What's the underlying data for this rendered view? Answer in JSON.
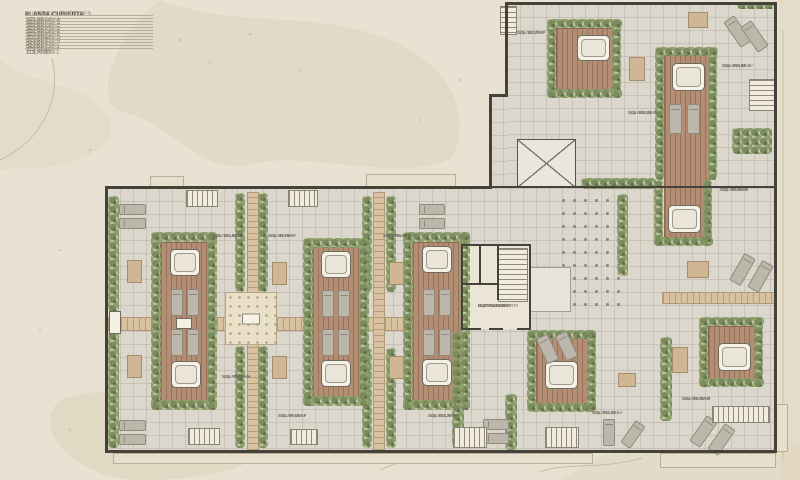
{
  "sheet": {
    "width": 800,
    "height": 480
  },
  "colors": {
    "background": "#e9e2d3",
    "paving": "#dcd7cd",
    "deck_wood": "#b48d75",
    "boardwalk_wood": "#d8c2a1",
    "hedge_green": "#7a8b5c",
    "wall": "#45423a",
    "label_text": "#6a6456",
    "legend_header": "#56524a",
    "terrain_blob": "#ddd2bb"
  },
  "legend": {
    "title_left": "SUPERFICIES ÚTILES",
    "title_right": "PLANTA CUBIERTA",
    "rows": [
      {
        "name": "SOLARIUM-A",
        "value": "103,90 m²"
      },
      {
        "name": "SOLARIUM-B",
        "value": "93,30 m²"
      },
      {
        "name": "SOLARIUM-C",
        "value": "102,85 m²"
      },
      {
        "name": "SOLARIUM-D",
        "value": "93,90 m²"
      },
      {
        "name": "SOLARIUM-E",
        "value": "106,40 m²"
      },
      {
        "name": "SOLARIUM-F",
        "value": "92,17 m²"
      },
      {
        "name": "SOLARIUM-G",
        "value": "112,50 m²"
      },
      {
        "name": "SOLARIUM-H",
        "value": "69,85 m²"
      },
      {
        "name": "SOLARIUM-I",
        "value": "84,65 m²"
      },
      {
        "name": "SOLARIUM-J",
        "value": "84,65 m²"
      },
      {
        "name": "SOLARIUM-K",
        "value": "113,70 m²"
      },
      {
        "name": "SOLARIUM-L",
        "value": "113,70 m²"
      }
    ]
  },
  "plan": {
    "paving": [
      [
        507,
        4,
        269,
        184
      ],
      [
        490,
        96,
        18,
        92
      ],
      [
        107,
        188,
        668,
        263
      ]
    ],
    "ledges": [
      [
        150,
        176,
        34,
        11
      ],
      [
        366,
        174,
        90,
        13
      ],
      [
        113,
        453,
        480,
        11
      ],
      [
        660,
        453,
        116,
        15
      ],
      [
        776,
        404,
        12,
        48
      ]
    ],
    "boardwalks_h": [
      [
        108,
        317,
        355,
        14
      ],
      [
        662,
        292,
        113,
        12
      ]
    ],
    "boardwalks_v": [
      [
        247,
        192,
        12,
        259
      ],
      [
        373,
        192,
        12,
        259
      ]
    ],
    "plaza": [
      [
        225,
        292,
        52,
        53
      ]
    ],
    "planters": [
      [
        109,
        311,
        12,
        23
      ],
      [
        176,
        318,
        16,
        11
      ]
    ],
    "dots": [
      [
        558,
        194,
        62,
        118
      ]
    ],
    "skylights_x": [
      [
        517,
        139,
        59,
        49
      ]
    ],
    "skylights_p": [
      [
        527,
        267,
        44,
        45
      ]
    ],
    "corefloor": [
      [
        462,
        246,
        68,
        83
      ]
    ],
    "decks": [
      [
        160,
        242,
        49,
        160
      ],
      [
        312,
        247,
        49,
        151
      ],
      [
        412,
        242,
        50,
        160
      ],
      [
        536,
        338,
        52,
        66
      ],
      [
        664,
        55,
        46,
        183
      ],
      [
        708,
        326,
        48,
        54
      ],
      [
        556,
        28,
        58,
        62
      ]
    ],
    "hedges": [
      [
        108,
        196,
        11,
        116
      ],
      [
        108,
        332,
        11,
        116
      ],
      [
        235,
        193,
        10,
        99
      ],
      [
        258,
        193,
        10,
        99
      ],
      [
        235,
        346,
        10,
        102
      ],
      [
        258,
        346,
        10,
        102
      ],
      [
        362,
        196,
        10,
        96
      ],
      [
        386,
        196,
        10,
        96
      ],
      [
        362,
        348,
        10,
        100
      ],
      [
        386,
        348,
        10,
        100
      ],
      [
        151,
        232,
        66,
        10
      ],
      [
        151,
        400,
        66,
        10
      ],
      [
        151,
        232,
        10,
        178
      ],
      [
        207,
        232,
        10,
        178
      ],
      [
        303,
        238,
        66,
        10
      ],
      [
        303,
        396,
        66,
        10
      ],
      [
        303,
        238,
        10,
        168
      ],
      [
        359,
        238,
        10,
        168
      ],
      [
        403,
        232,
        67,
        10
      ],
      [
        403,
        400,
        67,
        10
      ],
      [
        403,
        232,
        10,
        178
      ],
      [
        460,
        232,
        10,
        178
      ],
      [
        527,
        330,
        69,
        9
      ],
      [
        527,
        403,
        69,
        9
      ],
      [
        527,
        330,
        9,
        82
      ],
      [
        587,
        330,
        9,
        82
      ],
      [
        654,
        180,
        9,
        66
      ],
      [
        654,
        237,
        59,
        9
      ],
      [
        703,
        180,
        9,
        66
      ],
      [
        547,
        19,
        75,
        9
      ],
      [
        547,
        89,
        75,
        9
      ],
      [
        547,
        19,
        9,
        79
      ],
      [
        612,
        19,
        9,
        79
      ],
      [
        655,
        47,
        63,
        9
      ],
      [
        655,
        47,
        9,
        133
      ],
      [
        708,
        47,
        9,
        133
      ],
      [
        699,
        317,
        65,
        9
      ],
      [
        699,
        378,
        65,
        9
      ],
      [
        699,
        317,
        9,
        70
      ],
      [
        754,
        317,
        9,
        70
      ],
      [
        581,
        178,
        75,
        11
      ],
      [
        737,
        2,
        38,
        7
      ],
      [
        617,
        194,
        11,
        82
      ],
      [
        505,
        394,
        12,
        56
      ],
      [
        452,
        332,
        12,
        116
      ],
      [
        660,
        337,
        12,
        84
      ],
      [
        732,
        128,
        40,
        26
      ]
    ],
    "jacuzzis": [
      [
        170,
        249,
        30,
        27
      ],
      [
        171,
        361,
        30,
        27
      ],
      [
        321,
        251,
        30,
        27
      ],
      [
        321,
        360,
        30,
        27
      ],
      [
        422,
        246,
        30,
        27
      ],
      [
        422,
        359,
        30,
        27
      ],
      [
        545,
        361,
        33,
        28
      ],
      [
        672,
        63,
        33,
        28
      ],
      [
        668,
        205,
        33,
        28
      ],
      [
        718,
        343,
        33,
        28
      ],
      [
        577,
        35,
        33,
        26
      ]
    ],
    "beds": [
      [
        171,
        289,
        12,
        27
      ],
      [
        187,
        289,
        12,
        27
      ],
      [
        171,
        329,
        12,
        27
      ],
      [
        187,
        329,
        12,
        27
      ],
      [
        322,
        290,
        12,
        27
      ],
      [
        338,
        290,
        12,
        27
      ],
      [
        322,
        329,
        12,
        27
      ],
      [
        338,
        329,
        12,
        27
      ],
      [
        423,
        289,
        12,
        27
      ],
      [
        439,
        289,
        12,
        27
      ],
      [
        423,
        329,
        12,
        27
      ],
      [
        439,
        329,
        12,
        27
      ],
      [
        669,
        104,
        13,
        30
      ],
      [
        687,
        104,
        13,
        30
      ],
      [
        119,
        204,
        27,
        11
      ],
      [
        119,
        218,
        27,
        11
      ],
      [
        119,
        420,
        27,
        11
      ],
      [
        119,
        434,
        27,
        11
      ],
      [
        483,
        419,
        26,
        11
      ],
      [
        483,
        433,
        26,
        11
      ],
      [
        419,
        204,
        26,
        11
      ],
      [
        419,
        218,
        26,
        11
      ],
      [
        603,
        419,
        12,
        27
      ],
      [
        627,
        421,
        12,
        27,
        35
      ],
      [
        731,
        16,
        13,
        31,
        -35
      ],
      [
        748,
        21,
        13,
        31,
        -35
      ],
      [
        736,
        254,
        13,
        31,
        30
      ],
      [
        754,
        261,
        13,
        31,
        30
      ],
      [
        541,
        335,
        13,
        28,
        -25
      ],
      [
        560,
        332,
        13,
        28,
        -25
      ],
      [
        697,
        416,
        13,
        31,
        35
      ],
      [
        715,
        424,
        13,
        31,
        35
      ]
    ],
    "tables": [
      [
        127,
        260,
        15,
        23
      ],
      [
        127,
        355,
        15,
        23
      ],
      [
        272,
        262,
        15,
        23
      ],
      [
        272,
        356,
        15,
        23
      ],
      [
        389,
        262,
        15,
        23
      ],
      [
        389,
        356,
        15,
        23
      ],
      [
        672,
        347,
        16,
        26
      ],
      [
        629,
        57,
        16,
        24
      ],
      [
        687,
        261,
        22,
        17
      ],
      [
        688,
        12,
        20,
        16
      ],
      [
        618,
        373,
        18,
        14
      ]
    ],
    "stairs_h": [
      [
        186,
        190,
        32,
        17
      ],
      [
        288,
        190,
        30,
        17
      ],
      [
        188,
        428,
        32,
        17
      ],
      [
        290,
        429,
        28,
        16
      ],
      [
        453,
        427,
        34,
        21
      ],
      [
        545,
        427,
        34,
        21
      ],
      [
        712,
        406,
        58,
        17
      ]
    ],
    "stairs_v": [
      [
        749,
        79,
        26,
        32
      ],
      [
        500,
        6,
        17,
        29
      ],
      [
        498,
        248,
        30,
        54
      ]
    ],
    "walls": [
      [
        506,
        2,
        271,
        3
      ],
      [
        774,
        2,
        3,
        451
      ],
      [
        505,
        2,
        3,
        95
      ],
      [
        490,
        94,
        18,
        3
      ],
      [
        489,
        94,
        3,
        95
      ],
      [
        105,
        186,
        387,
        3
      ],
      [
        489,
        186,
        288,
        2
      ],
      [
        105,
        186,
        3,
        267
      ],
      [
        105,
        450,
        672,
        3
      ],
      [
        461,
        244,
        70,
        2
      ],
      [
        461,
        244,
        2,
        86
      ],
      [
        529,
        244,
        2,
        86
      ],
      [
        461,
        328,
        20,
        2
      ],
      [
        489,
        328,
        14,
        2
      ],
      [
        517,
        328,
        14,
        2
      ],
      [
        461,
        283,
        38,
        2
      ],
      [
        479,
        244,
        2,
        40
      ],
      [
        497,
        244,
        2,
        56
      ]
    ],
    "labels": [
      {
        "x": 517,
        "y": 30,
        "lines": [
          "SOLARIUM-F",
          "Sup: 92,17 m²"
        ]
      },
      {
        "x": 722,
        "y": 63,
        "lines": [
          "SOLARIUM-A",
          "Sup: 103,90 m²"
        ]
      },
      {
        "x": 628,
        "y": 110,
        "lines": [
          "SOLARIUM-C",
          "Sup: 102,85 m²"
        ]
      },
      {
        "x": 720,
        "y": 187,
        "lines": [
          "SOLARIUM-D",
          "Sup: 93,90 m²"
        ]
      },
      {
        "x": 213,
        "y": 233,
        "lines": [
          "SOLARIUM-G",
          "Sup: 112,50 m²"
        ]
      },
      {
        "x": 268,
        "y": 233,
        "lines": [
          "SOLARIUM-I",
          "Sup: 84,65 m²"
        ]
      },
      {
        "x": 383,
        "y": 233,
        "lines": [
          "SOLARIUM-E",
          "Sup: 106,40 m²"
        ]
      },
      {
        "x": 222,
        "y": 374,
        "lines": [
          "SOLARIUM-H",
          "Sup: 69,85 m²"
        ]
      },
      {
        "x": 278,
        "y": 413,
        "lines": [
          "SOLARIUM-J",
          "Sup: 84,65 m²"
        ]
      },
      {
        "x": 428,
        "y": 413,
        "lines": [
          "SOLARIUM-K",
          "Sup: 113,70 m²"
        ]
      },
      {
        "x": 592,
        "y": 410,
        "lines": [
          "SOLARIUM-L",
          "Sup: 113,70 m²"
        ]
      },
      {
        "x": 682,
        "y": 396,
        "lines": [
          "SOLARIUM-B",
          "Sup: 93,30 m²"
        ]
      },
      {
        "x": 478,
        "y": 303,
        "lines": [
          "DISTRIBUIDOR",
          "PLANTA CUBIERTA",
          "Sup: 71,95 m²"
        ]
      }
    ]
  }
}
